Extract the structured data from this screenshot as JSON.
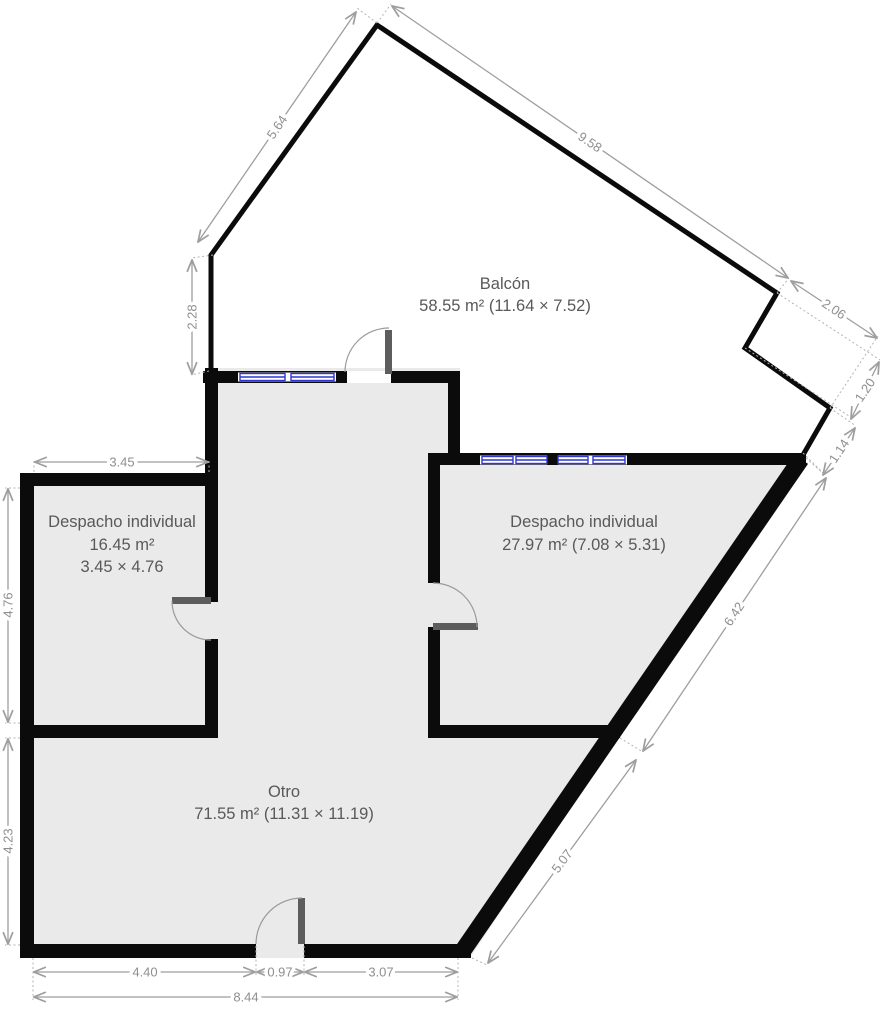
{
  "rooms": {
    "balcon": {
      "name": "Balcón",
      "area": "58.55 m² (11.64 × 7.52)"
    },
    "despacho_left": {
      "name": "Despacho individual",
      "area": "16.45 m²",
      "size": "3.45 × 4.76"
    },
    "despacho_right": {
      "name": "Despacho individual",
      "area": "27.97 m² (7.08 × 5.31)"
    },
    "otro": {
      "name": "Otro",
      "area": "71.55 m² (11.31 × 11.19)"
    }
  },
  "dims": {
    "d5_64": "5.64",
    "d9_58": "9.58",
    "d2_06": "2.06",
    "d1_20": "1.20",
    "d1_14": "1.14",
    "d2_28": "2.28",
    "d3_45": "3.45",
    "d4_76": "4.76",
    "d4_23": "4.23",
    "d6_42": "6.42",
    "d5_07": "5.07",
    "d4_40": "4.40",
    "d0_97": "0.97",
    "d3_07": "3.07",
    "d8_44": "8.44"
  },
  "colors": {
    "wall": "#0b0b0b",
    "floor_fill": "#eaeaea",
    "window_blue": "#2f36cf",
    "dimension_line": "#9e9e9e",
    "dimension_text": "#8f8f8f",
    "room_text": "#595959",
    "door_leaf": "#5d5d5d"
  }
}
